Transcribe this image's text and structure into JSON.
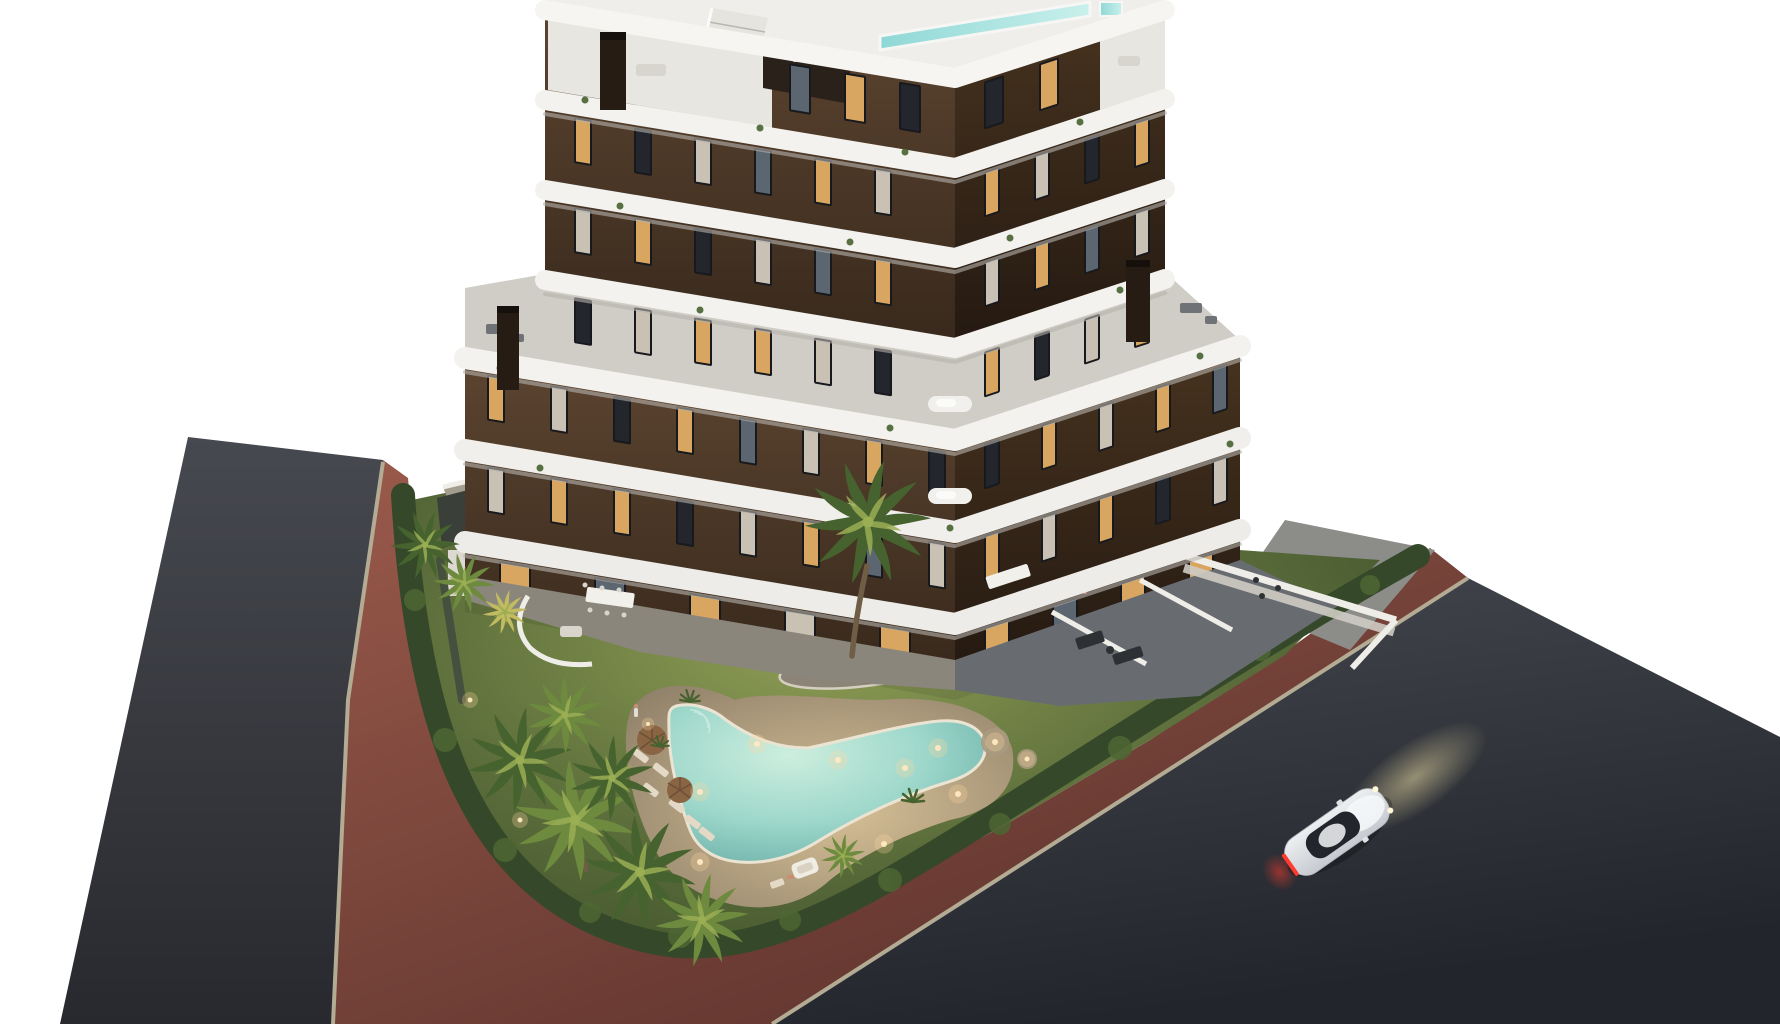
{
  "meta": {
    "image_type": "3d-architectural-render",
    "description": "Aerial dusk rendering of a modern apartment building with curved white balconies, landscaped garden, illuminated boomerang-shaped pool, palm trees, perimeter roads with red bike path, and a white coupe driving on the road",
    "background": "#ffffff"
  },
  "palette": {
    "background": "#ffffff",
    "asphalt_left_1": "#474950",
    "asphalt_left_2": "#27292e",
    "asphalt_right_1": "#45484f",
    "asphalt_right_2": "#22252b",
    "curb": "#b3ab94",
    "path_red_1": "#9a5a4b",
    "path_red_2": "#5d332d",
    "sidewalk": "#8c8d89",
    "lawn_light": "#8f9e55",
    "lawn_mid": "#5a6c3a",
    "lawn_dark": "#3c4f2a",
    "hedge": "#35492a",
    "hedge_light": "#4d6632",
    "palm_dark": "#46622f",
    "palm_tone_light": "#6d8a3e",
    "palm_light": "#9aae54",
    "palm_accent": "#c2bb62",
    "trunk": "#6f5d46",
    "island_gravel": "#8b8477",
    "island_rim": "#d5cfc0",
    "deck_light": "#d6c096",
    "deck_dark": "#8d7e68",
    "pool_center": "#cdeede",
    "pool_mid": "#9ed8cb",
    "pool_edge": "#62a8a2",
    "pool_rim": "#ece4d2",
    "pool_roof": "#8fd8d6",
    "slab_white": "#f3f2ee",
    "slab_shadow": "#b5b3ae",
    "terrace_floor": "#d0cdc6",
    "facade_left_1": "#5c4430",
    "facade_left_2": "#38291c",
    "facade_right_1": "#47331f",
    "facade_right_2": "#241911",
    "window_lit": "#d8a660",
    "window_dark": "#23262c",
    "window_curtain": "#c9c1b4",
    "window_glass": "#5c6670",
    "window_frame": "#17191d",
    "chimney": "#261c13",
    "stairs": "#e6e4df",
    "pergola": "#2a211a",
    "courtyard": "#a39d8f",
    "terrace_tile_left": "#8a867b",
    "terrace_tile_right": "#686c71",
    "wall_white": "#efede7",
    "wall_face": "#cfccc4",
    "table_white": "#f2f0ea",
    "furniture_dark": "#2e3134",
    "umbrella": "#8a6544",
    "lounger": "#e3d9c6",
    "cabana": "#efece4",
    "person_skin": "#c89070",
    "person_light": "#e0ddd6",
    "car_body": "#edeff1",
    "car_body_2": "#c6cad0",
    "car_glass": "#22262c",
    "car_tail": "#ff3b2d",
    "car_beam": "#e8d9a2",
    "light_warm": "#ffd9a0",
    "light_core": "#ffe9c0"
  },
  "scene": {
    "building": {
      "floors_visible": 6,
      "wings": 2,
      "style": "staggered white curved balcony bands over dark brown facade, rooftop pool, roof stairs, chimneys",
      "window_rows": [
        {
          "group": "win-left",
          "y": -68.4,
          "x0": 790,
          "step": 55,
          "count": 3,
          "w": 20,
          "h": 46,
          "pattern": [
            "glass",
            "lit",
            "dark"
          ]
        },
        {
          "group": "win-left",
          "y": 21.6,
          "x0": 575,
          "step": 60,
          "count": 6,
          "w": 16,
          "h": 44,
          "pattern": [
            "lit",
            "dark",
            "curtain",
            "glass",
            "lit",
            "curtain"
          ]
        },
        {
          "group": "win-left",
          "y": 111.6,
          "x0": 575,
          "step": 60,
          "count": 6,
          "w": 16,
          "h": 44,
          "pattern": [
            "curtain",
            "lit",
            "dark",
            "curtain",
            "glass",
            "lit"
          ]
        },
        {
          "group": "win-left",
          "y": 201.6,
          "x0": 575,
          "step": 60,
          "count": 6,
          "w": 16,
          "h": 44,
          "pattern": [
            "dark",
            "curtain",
            "lit",
            "lit",
            "curtain",
            "dark"
          ]
        },
        {
          "group": "win-left",
          "y": 293.6,
          "x0": 488,
          "step": 63,
          "count": 8,
          "w": 16,
          "h": 44,
          "pattern": [
            "lit",
            "curtain",
            "dark",
            "lit",
            "glass",
            "curtain",
            "lit",
            "dark"
          ]
        },
        {
          "group": "win-left",
          "y": 385.6,
          "x0": 488,
          "step": 63,
          "count": 8,
          "w": 16,
          "h": 44,
          "pattern": [
            "curtain",
            "lit",
            "lit",
            "dark",
            "curtain",
            "lit",
            "glass",
            "curtain"
          ]
        },
        {
          "group": "win-left",
          "y": 478,
          "x0": 500,
          "step": 95,
          "count": 5,
          "w": 30,
          "h": 28,
          "pattern": [
            "lit",
            "glass",
            "lit",
            "curtain",
            "lit"
          ]
        },
        {
          "group": "win-right",
          "y": 405.2,
          "x0": 985,
          "step": 55,
          "count": 2,
          "w": 18,
          "h": 46,
          "pattern": [
            "dark",
            "lit"
          ]
        },
        {
          "group": "win-right",
          "y": 495.2,
          "x0": 985,
          "step": 50,
          "count": 4,
          "w": 14,
          "h": 44,
          "pattern": [
            "lit",
            "curtain",
            "dark",
            "lit"
          ]
        },
        {
          "group": "win-right",
          "y": 585.2,
          "x0": 985,
          "step": 50,
          "count": 4,
          "w": 14,
          "h": 44,
          "pattern": [
            "curtain",
            "lit",
            "glass",
            "curtain"
          ]
        },
        {
          "group": "win-right",
          "y": 675.2,
          "x0": 985,
          "step": 50,
          "count": 4,
          "w": 14,
          "h": 44,
          "pattern": [
            "lit",
            "dark",
            "curtain",
            "lit"
          ]
        },
        {
          "group": "win-right",
          "y": 767.2,
          "x0": 985,
          "step": 57,
          "count": 5,
          "w": 14,
          "h": 44,
          "pattern": [
            "dark",
            "lit",
            "curtain",
            "lit",
            "glass"
          ]
        },
        {
          "group": "win-right",
          "y": 859.2,
          "x0": 985,
          "step": 57,
          "count": 5,
          "w": 14,
          "h": 44,
          "pattern": [
            "lit",
            "curtain",
            "lit",
            "dark",
            "curtain"
          ]
        },
        {
          "group": "win-right",
          "y": 951.2,
          "x0": 985,
          "step": 68,
          "count": 4,
          "w": 24,
          "h": 26,
          "pattern": [
            "lit",
            "glass",
            "lit",
            "lit"
          ]
        }
      ]
    },
    "garden": {
      "pool_shape": "boomerang with beach deck, underwater lights on",
      "palms": [
        {
          "x": 425,
          "y": 545,
          "s": 0.85,
          "r": 10,
          "tone": "palm_dark"
        },
        {
          "x": 464,
          "y": 583,
          "s": 0.75,
          "r": -20,
          "tone": "palm_tone_light"
        },
        {
          "x": 505,
          "y": 612,
          "s": 0.55,
          "r": 5,
          "tone": "palm_accent"
        },
        {
          "x": 520,
          "y": 760,
          "s": 1.3,
          "r": 0,
          "tone": "palm_dark"
        },
        {
          "x": 575,
          "y": 820,
          "s": 1.5,
          "r": 24,
          "tone": "palm_tone_light"
        },
        {
          "x": 640,
          "y": 872,
          "s": 1.4,
          "r": -12,
          "tone": "palm_dark"
        },
        {
          "x": 702,
          "y": 920,
          "s": 1.15,
          "r": 40,
          "tone": "palm_tone_light"
        },
        {
          "x": 565,
          "y": 715,
          "s": 0.95,
          "r": 65,
          "tone": "palm_tone_light"
        },
        {
          "x": 612,
          "y": 778,
          "s": 1.05,
          "r": -40,
          "tone": "palm_dark"
        },
        {
          "x": 843,
          "y": 856,
          "s": 0.55,
          "r": 0,
          "tone": "palm_tone_light"
        },
        {
          "x": 868,
          "y": 522,
          "s": 1.55,
          "r": 8,
          "tone": "palm_dark"
        }
      ],
      "shrubs": [
        {
          "x": 808,
          "y": 661,
          "s": 0.5
        },
        {
          "x": 846,
          "y": 656,
          "s": 0.6
        },
        {
          "x": 902,
          "y": 661,
          "s": 0.55
        },
        {
          "x": 932,
          "y": 668,
          "s": 0.45
        },
        {
          "x": 1030,
          "y": 655,
          "s": 0.5
        },
        {
          "x": 1068,
          "y": 690,
          "s": 0.55
        },
        {
          "x": 1105,
          "y": 662,
          "s": 0.45
        },
        {
          "x": 913,
          "y": 800,
          "s": 0.5
        },
        {
          "x": 958,
          "y": 640,
          "s": 0.4
        },
        {
          "x": 690,
          "y": 700,
          "s": 0.45
        },
        {
          "x": 660,
          "y": 745,
          "s": 0.4
        }
      ],
      "lights": [
        {
          "x": 757,
          "y": 744,
          "r": 3
        },
        {
          "x": 838,
          "y": 760,
          "r": 3
        },
        {
          "x": 905,
          "y": 768,
          "r": 3
        },
        {
          "x": 700,
          "y": 792,
          "r": 3
        },
        {
          "x": 938,
          "y": 748,
          "r": 3
        },
        {
          "x": 822,
          "y": 664,
          "r": 2.5
        },
        {
          "x": 908,
          "y": 666,
          "r": 2.5
        },
        {
          "x": 700,
          "y": 862,
          "r": 3
        },
        {
          "x": 884,
          "y": 844,
          "r": 3
        },
        {
          "x": 958,
          "y": 794,
          "r": 3
        },
        {
          "x": 995,
          "y": 742,
          "r": 3
        },
        {
          "x": 1027,
          "y": 759,
          "r": 2.5
        },
        {
          "x": 470,
          "y": 700,
          "r": 2.5
        },
        {
          "x": 520,
          "y": 820,
          "r": 2.5
        },
        {
          "x": 648,
          "y": 724,
          "r": 2
        }
      ]
    },
    "car": {
      "type": "white coupe",
      "state": "driving with taillights and headlights on"
    },
    "roads": {
      "left": "asphalt street",
      "right": "asphalt street",
      "path": "red bike path around corner",
      "curbs": "light stone curbs"
    }
  }
}
